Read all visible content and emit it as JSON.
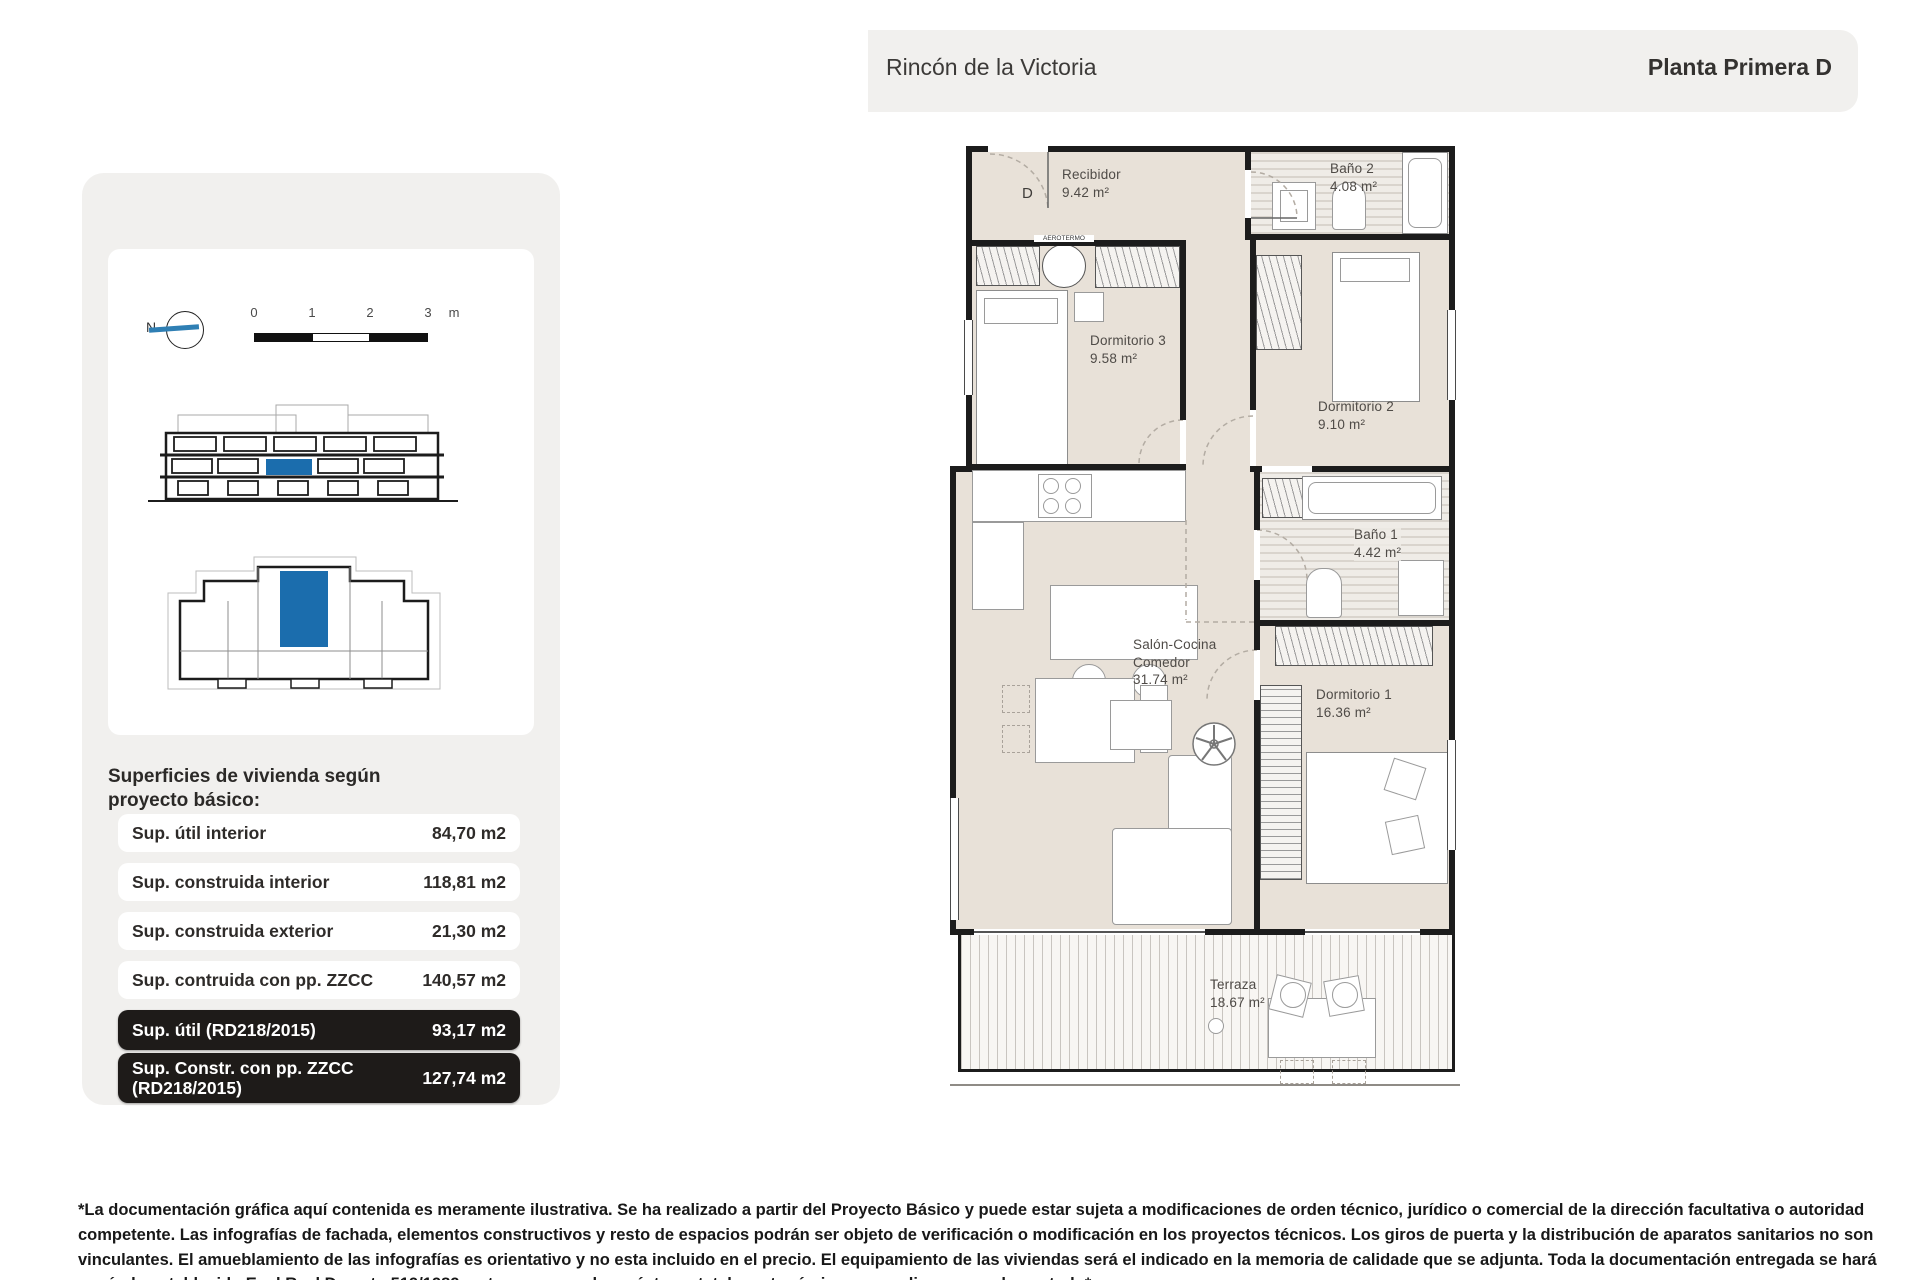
{
  "header": {
    "project": "Rincón de la Victoria",
    "plan_name": "Planta Primera D"
  },
  "sidebar": {
    "compass": {
      "north_label": "N"
    },
    "scale": {
      "ticks": [
        "0",
        "1",
        "2",
        "3"
      ],
      "unit": "m"
    },
    "surfaces": {
      "heading": "Superficies de vivienda según proyecto básico:",
      "rows": [
        {
          "label": "Sup. útil interior",
          "value": "84,70 m2"
        },
        {
          "label": "Sup. construida interior",
          "value": "118,81 m2"
        },
        {
          "label": "Sup. construida exterior",
          "value": "21,30 m2"
        },
        {
          "label": "Sup. contruida con pp. ZZCC",
          "value": "140,57 m2"
        },
        {
          "label": "Sup. útil (RD218/2015)",
          "value": "93,17 m2"
        },
        {
          "label": "Sup. Constr. con pp. ZZCC (RD218/2015)",
          "value": "127,74 m2"
        }
      ]
    }
  },
  "plan": {
    "entrance_label": "D",
    "aerotermo_label": "AEROTERMO",
    "rooms": [
      {
        "name": "Recibidor",
        "area": "9.42 m²"
      },
      {
        "name": "Baño 2",
        "area": "4.08 m²"
      },
      {
        "name": "Dormitorio 3",
        "area": "9.58 m²"
      },
      {
        "name": "Dormitorio 2",
        "area": "9.10 m²"
      },
      {
        "name": "Baño 1",
        "area": "4.42 m²"
      },
      {
        "name": "Salón-Cocina Comedor",
        "area": "31.74 m²"
      },
      {
        "name": "Dormitorio 1",
        "area": "16.36 m²"
      },
      {
        "name": "Terraza",
        "area": "18.67 m²"
      }
    ]
  },
  "footer": {
    "disclaimer": "*La documentación gráfica aquí contenida es meramente ilustrativa. Se ha realizado a partir del Proyecto Básico y puede estar sujeta a modificaciones de orden técnico, jurídico o comercial de la dirección facultativa o autoridad competente. Las infografías de fachada, elementos constructivos y resto de espacios podrán ser objeto de verificación o modificación en los proyectos técnicos. Los giros de puerta y la distribución de aparatos sanitarios no son vinculantes. El amueblamiento de las infografías es orientativo y no esta incluido en el precio. El equipamiento de las viviendas será el indicado en la memoria de calidade que se adjunta. Toda la documentación entregada se hará según lo establecido Enel Real Decreto 519/1989 y otras normas de carácter estatal o autonómico que pudieran complementarlo*"
  },
  "colors": {
    "accent_blue": "#1b6dad",
    "panel_gray": "#f1f0ee",
    "plan_beige": "#e8e1d8",
    "dark_row": "#1e1b19",
    "wall": "#1c1c1c"
  }
}
